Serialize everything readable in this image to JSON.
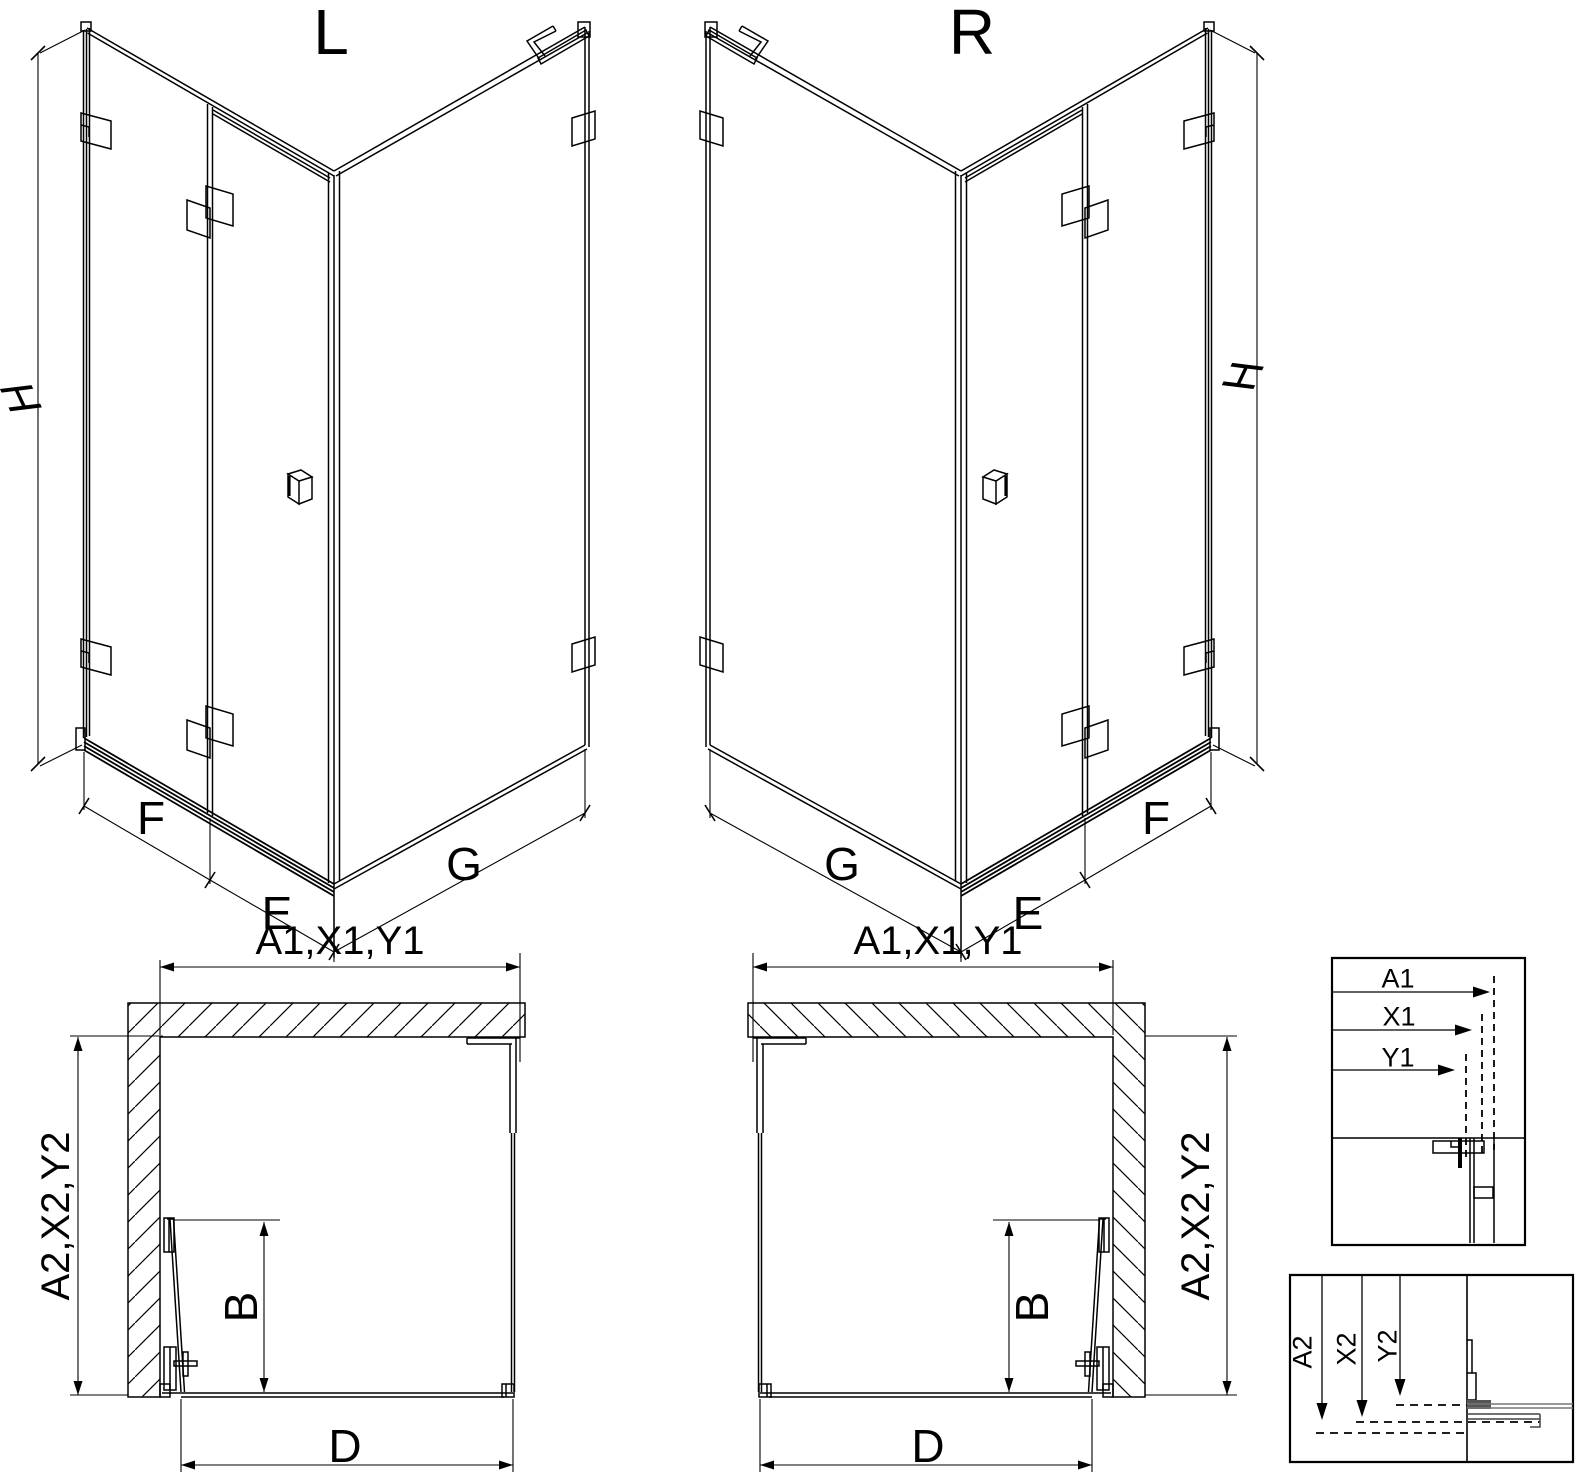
{
  "drawing": {
    "background": "#ffffff",
    "line_color": "#000000",
    "iso_left": {
      "title": "L",
      "height": "H",
      "front_fixed": "F",
      "front_door": "E",
      "side_panel": "G"
    },
    "iso_right": {
      "title": "R",
      "height": "H",
      "front_fixed": "F",
      "front_door": "E",
      "side_panel": "G"
    },
    "plan_left": {
      "width": "A1,X1,Y1",
      "depth": "A2,X2,Y2",
      "door": "B",
      "entry": "D"
    },
    "plan_right": {
      "width": "A1,X1,Y1",
      "depth": "A2,X2,Y2",
      "door": "B",
      "entry": "D"
    },
    "detail_width": {
      "labels": [
        "A1",
        "X1",
        "Y1"
      ]
    },
    "detail_depth": {
      "labels": [
        "A2",
        "X2",
        "Y2"
      ]
    }
  }
}
